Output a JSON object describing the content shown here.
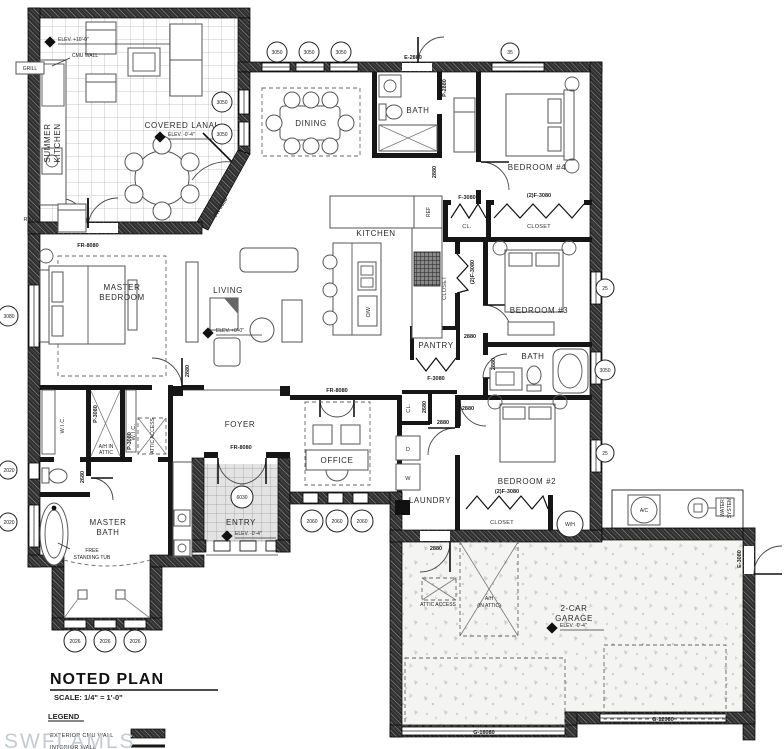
{
  "watermark": "SWFLAMLS",
  "title_block": {
    "title": "NOTED PLAN",
    "scale": "SCALE:  1/4\" = 1'-0\"",
    "legend_title": "LEGEND",
    "legend": [
      {
        "label": "EXTERIOR CMU WALL",
        "swatch": "cmu-hatch"
      },
      {
        "label": "INTERIOR WALL",
        "swatch": "solid-line"
      }
    ]
  },
  "rooms": {
    "summer_kitchen": [
      "SUMMER",
      "KITCHEN"
    ],
    "covered_lanai": "COVERED LANAI",
    "dining": "DINING",
    "bath1": "BATH",
    "bedroom4": "BEDROOM #4",
    "kitchen": "KITCHEN",
    "cl_hall": "CL.",
    "closet_bed4": "CLOSET",
    "closet_tall": "CLOSET",
    "pantry": "PANTRY",
    "bedroom3": "BEDROOM #3",
    "bath2": "BATH",
    "living": "LIVING",
    "master_bedroom": [
      "MASTER",
      "BEDROOM"
    ],
    "foyer": "FOYER",
    "office": "OFFICE",
    "wic1": "W.I.C.",
    "wic2": "W.I.C.",
    "ah_attic_closet": [
      "A/H IN",
      "ATTIC"
    ],
    "attic_access_hall": "ATTIC ACCESS",
    "master_bath": [
      "MASTER",
      "BATH"
    ],
    "entry": "ENTRY",
    "laundry": "LAUNDRY",
    "cl_laundry": "CL.",
    "bedroom2": "BEDROOM #2",
    "closet_bed2": "CLOSET",
    "garage": [
      "2-CAR",
      "GARAGE"
    ],
    "attic_access_garage": "ATTIC ACCESS",
    "ah_garage": [
      "A/H",
      "(IN ATTIC)"
    ]
  },
  "fixtures": {
    "ref_lanai": "REF.",
    "grill": "GRILL",
    "ref_kitchen": "REF",
    "dw": "D/W",
    "washer": "W",
    "dryer": "D",
    "free_standing_tub": [
      "FREE",
      "STANDING TUB"
    ],
    "ac": "A/C",
    "water_system": [
      "WATER",
      "SYSTEM"
    ],
    "water_heater": "W/H",
    "cmu_wall_note": "CMU WALL"
  },
  "elevations": {
    "summer_kitchen": "ELEV. +10'-0\"",
    "lanai": "ELEV. -0'-4\"",
    "living": "ELEV. +0'-0\"",
    "entry": "ELEV. -0'-4\"",
    "garage": "ELEV. -0'-4\""
  },
  "door_tags": {
    "fr8080": "FR-8080",
    "e2880": "E-2880",
    "p2880": "P-2880",
    "d2880": "2880",
    "d2680": "2680",
    "f3080": "F-3080",
    "f3080x2": "(2)F-3080",
    "p3080": "P-3080",
    "e3080": "E-3080",
    "g16080": "G-16080",
    "g12080": "G-12080"
  },
  "window_tags": {
    "t3050": "3050",
    "t35": "35",
    "t25": "25",
    "t3080": "3080",
    "t2020": "2020",
    "t2026": "2026",
    "t2060": "2060",
    "t6030": "6030"
  }
}
